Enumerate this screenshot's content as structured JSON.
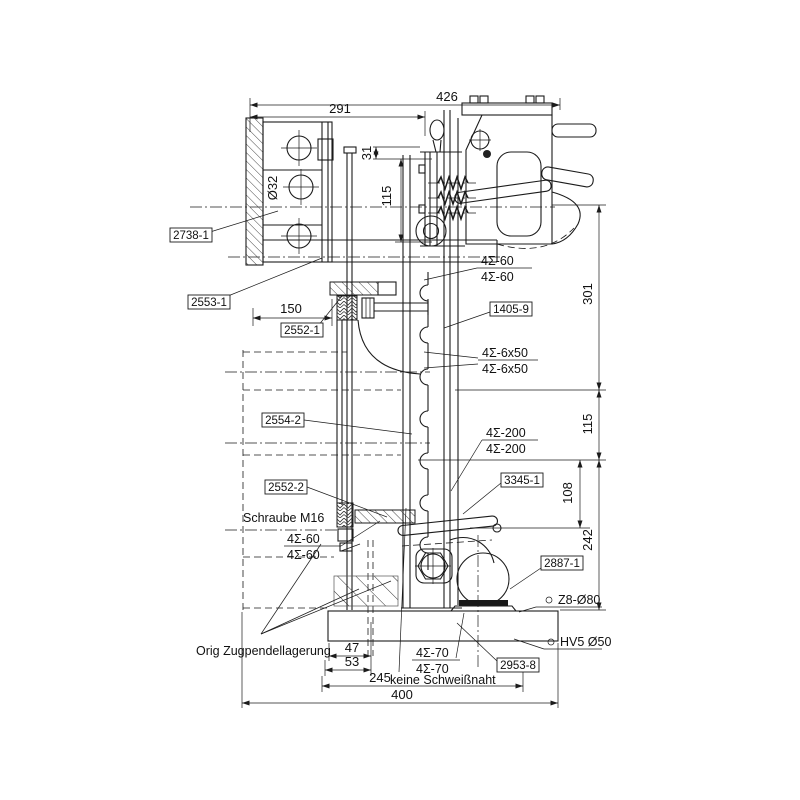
{
  "drawing": {
    "dimensions": {
      "top_total": "426",
      "top_inner": "291",
      "wall_to_plate": "150",
      "head_offset": "31",
      "head_height": "115",
      "hole_dia": "Ø32",
      "right_total": "301",
      "right_mid": "115",
      "right_inner": "108",
      "right_lower": "242",
      "base_a": "47",
      "base_b": "53",
      "base_c": "245",
      "base_total": "400"
    },
    "parts": {
      "p2738_1": "2738-1",
      "p2553_1": "2553-1",
      "p2552_1": "2552-1",
      "p2554_2": "2554-2",
      "p2552_2": "2552-2",
      "p1405_9": "1405-9",
      "p3345_1": "3345-1",
      "p2887_1": "2887-1",
      "p2953_8": "2953-8"
    },
    "welds": {
      "w60": "4Σ-60",
      "w6x50": "4Σ-6x50",
      "w200": "4Σ-200",
      "w70": "4Σ-70",
      "z8": "Z8-Ø80",
      "hv5": "HV5 Ø50"
    },
    "notes": {
      "screw": "Schraube M16",
      "no_weld": "keine Schweißnaht",
      "orig": "Orig Zugpendellagerung"
    }
  }
}
